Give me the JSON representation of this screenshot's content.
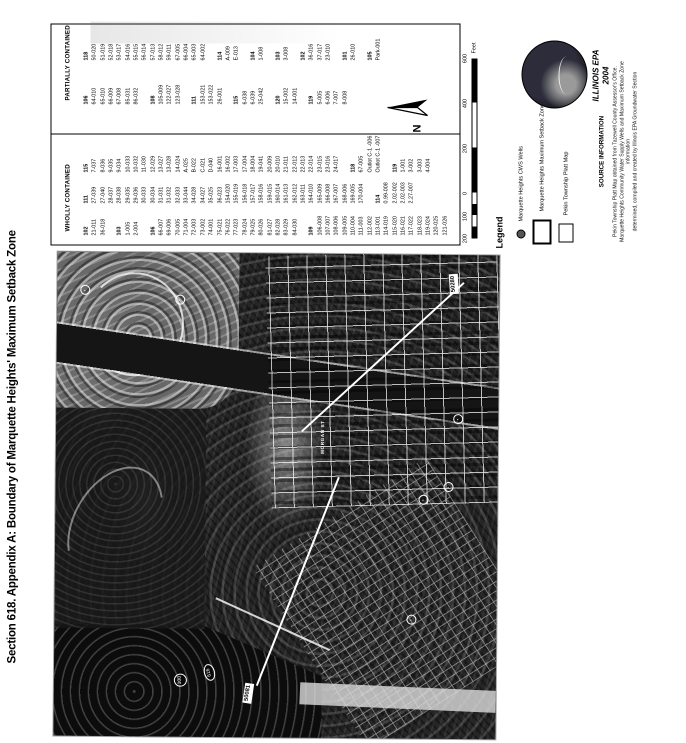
{
  "title": "Section 618. Appendix A: Boundary of Marquette Heights' Maximum Setback Zone",
  "table": {
    "wholly_header": "WHOLLY CONTAINED",
    "partially_header": "PARTIALLY CONTAINED",
    "wholly_columns": {
      "col1": [
        "#102",
        "21-011",
        "36-018",
        "",
        "#103",
        "1-005",
        "2-004",
        "",
        "#106",
        "66-007",
        "69-006",
        "70-005",
        "71-004",
        "72-003",
        "73-002",
        "74-001",
        "75-021",
        "76-022",
        "77-023",
        "78-024",
        "79-025",
        "80-026",
        "81-027",
        "82-028",
        "83-029",
        "84-030",
        "",
        "#109",
        "106-008",
        "107-007",
        "108-006",
        "109-005",
        "110-004",
        "111-003",
        "112-002",
        "113-001",
        "114-019",
        "115-020",
        "116-021",
        "117-022",
        "118-023",
        "119-024",
        "120-025",
        "121-026"
      ],
      "col2": [
        "#111",
        "27-039",
        "27-040",
        "28-037",
        "28-038",
        "29-035",
        "29-036",
        "30-033",
        "30-034",
        "31-031",
        "31-032",
        "32-033",
        "33-044",
        "34-028",
        "34-027",
        "35-025",
        "36-023",
        "154-020",
        "155-019",
        "156-018",
        "157-017",
        "158-016",
        "159-015",
        "160-014",
        "161-013",
        "162-012",
        "163-011",
        "164-010",
        "165-009",
        "166-008",
        "167-007",
        "168-006",
        "169-005",
        "170-004",
        "",
        "#114",
        "0.99-008",
        "2.02-002",
        "2.02-003",
        "2.27-007"
      ],
      "col3": [
        "#115",
        "7-037",
        "8-036",
        "9-035",
        "9-034",
        "10-033",
        "10-032",
        "11-030",
        "12-029",
        "13-027",
        "13-028",
        "14-024",
        "A-025",
        "B-022",
        "C-021",
        "D-040",
        "16-001",
        "16-002",
        "17-003",
        "17-004",
        "18-004",
        "19-041",
        "20-009",
        "20-010",
        "21-011",
        "22-012",
        "22-013",
        "22-014",
        "23-015",
        "23-016",
        "24-017",
        "",
        "#118",
        "67-005",
        "Outlot C-1 -006",
        "Outlot C-1 -007",
        "",
        "#119",
        "1-001",
        "3-002",
        "3-003",
        "4-004"
      ]
    },
    "partially_columns": {
      "col1": [
        "#106",
        "64-010",
        "65-010",
        "66-009",
        "67-008",
        "85-031",
        "86-032",
        "",
        "#108",
        "105-009",
        "122-027",
        "123-028",
        "",
        "#111",
        "153-021",
        "153-022",
        "26-001",
        "",
        "#115",
        "6-038",
        "6-039",
        "25-042",
        "",
        "#120",
        "15-002",
        "14-001",
        "",
        "#119",
        "5-005",
        "6-006",
        "7-007",
        "8-008"
      ],
      "col2": [
        "#118",
        "50-020",
        "51-019",
        "52-018",
        "53-017",
        "54-016",
        "55-015",
        "56-014",
        "57-013",
        "58-012",
        "59-011",
        "67-005",
        "66-004",
        "65-003",
        "64-002",
        "",
        "#114",
        "A-009",
        "E-013",
        "",
        "#104",
        "1-008",
        "",
        "#103",
        "3-008",
        "",
        "#102",
        "36-016",
        "37-017",
        "23-010",
        "",
        "#101",
        "26-010",
        "",
        "#105",
        "Park-001"
      ]
    }
  },
  "north_label": "N",
  "scalebar": {
    "labels": [
      "200",
      "100",
      "0",
      "200",
      "400",
      "600"
    ],
    "unit": "Feet"
  },
  "legend": {
    "heading": "Legend",
    "items": [
      {
        "symbol": "well-circle",
        "label": "Marquette Heights CWS Wells"
      },
      {
        "symbol": "thick-rect",
        "label": "Marquette Heights Maximum Setback Zone"
      },
      {
        "symbol": "thin-rect",
        "label": "Pekin Township Platt Map"
      }
    ]
  },
  "epa": {
    "agency": "ILLINOIS EPA",
    "year": "2004"
  },
  "source": {
    "heading": "SOURCE INFORMATION",
    "lines": [
      "Pekin Township Platt Map obtained from Tazewell County Assessor's Office.",
      "Marquette Heights Community Water Supply Wells and Maximum Setback Zone information",
      "determined, compiled and created by Illinois EPA Groundwater Section"
    ]
  },
  "map": {
    "well_labels": [
      "50081",
      "50280"
    ],
    "route_markers": [
      "616",
      "100"
    ],
    "street_label": "MORGAN ST"
  },
  "colors": {
    "photo_base": "#262626",
    "ink": "#000000",
    "annotation": "#ffffff"
  }
}
